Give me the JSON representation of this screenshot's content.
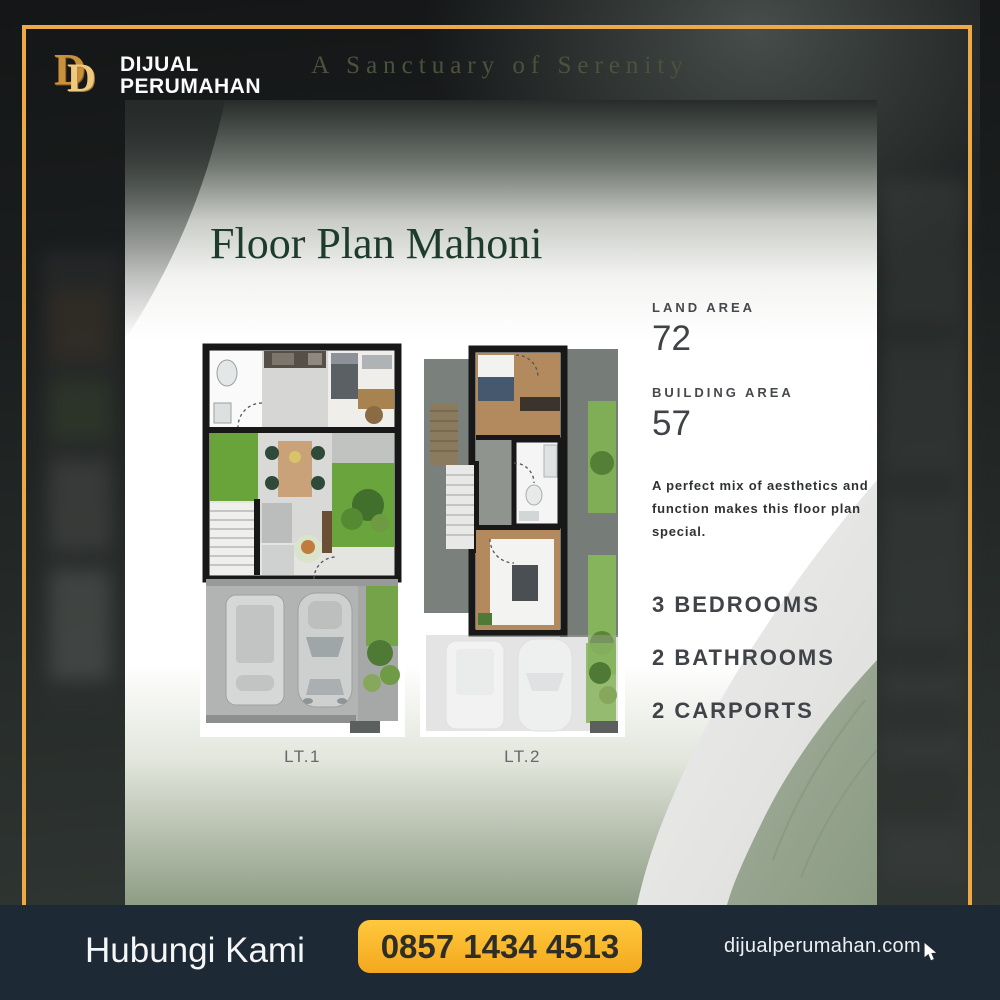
{
  "brand": {
    "monogram_d1": "D",
    "monogram_d2": "D",
    "name_line1": "DIJUAL",
    "name_line2": "PERUMAHAN",
    "tagline": "A Sanctuary of Serenity"
  },
  "card": {
    "title": "Floor Plan Mahoni",
    "land_area": {
      "label": "LAND AREA",
      "value": "72"
    },
    "building_area": {
      "label": "BUILDING AREA",
      "value": "57"
    },
    "description": "A perfect mix of aesthetics and function makes this floor plan special.",
    "features": [
      "3 BEDROOMS",
      "2 BATHROOMS",
      "2 CARPORTS"
    ],
    "floors": [
      {
        "label": "LT.1"
      },
      {
        "label": "LT.2"
      }
    ]
  },
  "footer": {
    "contact_label": "Hubungi Kami",
    "phone": "0857 1434 4513",
    "website": "dijualperumahan.com"
  },
  "colors": {
    "gold_border": "#edaa44",
    "button_gold": "#f6ad22",
    "footer_bg": "#1d2a36",
    "title_green": "#1e3c2b",
    "card_bottom_sage": "#8e9d86"
  }
}
